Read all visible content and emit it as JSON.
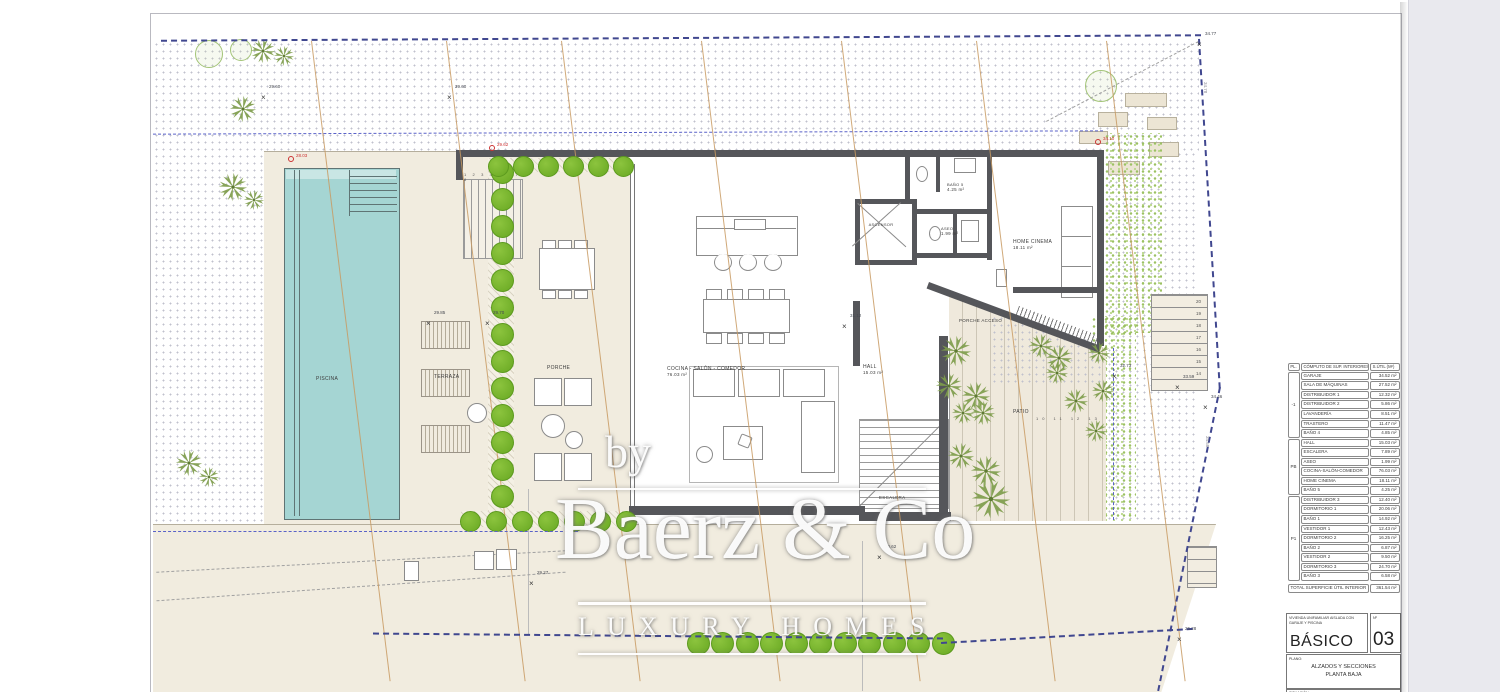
{
  "watermark": {
    "by": "by",
    "brand": "Baerz & Co",
    "tagline": "LUXURY HOMES"
  },
  "rooms": {
    "piscina": {
      "label": "PISCINA"
    },
    "terraza": {
      "label": "TERRAZA"
    },
    "porche": {
      "label": "PORCHE"
    },
    "cocina": {
      "label": "COCINA - SALÓN - COMEDOR",
      "area": "76.03 m²"
    },
    "hall": {
      "label": "HALL",
      "area": "15.03 m²"
    },
    "ascensor": {
      "label": "ASCENSOR"
    },
    "bano5": {
      "label": "BAÑO 5",
      "area": "4.25 m²"
    },
    "aseo": {
      "label": "ASEO",
      "area": "1.99 m²"
    },
    "home_cinema": {
      "label": "HOME CINEMA",
      "area": "18.11 m²"
    },
    "porche_acceso": {
      "label": "PORCHE ACCESO"
    },
    "patio": {
      "label": "PATIO"
    },
    "escalera": {
      "label": "ESCALERA"
    }
  },
  "stairs": {
    "porch_numbers": "1 2 3 4 5 6 7 8",
    "exterior_numbers": [
      "20",
      "19",
      "18",
      "17",
      "16",
      "15",
      "14"
    ],
    "patio_numbers": "10  11  12  13"
  },
  "site_markers": [
    {
      "label": "34.77",
      "x": 1196,
      "y": 33,
      "type": "x",
      "color": "#44474f"
    },
    {
      "label": "34.78",
      "x": 1207,
      "y": 84,
      "type": "plain",
      "color": "#8b8b95"
    },
    {
      "label": "29.60",
      "x": 260,
      "y": 86,
      "type": "x",
      "color": "#44474f"
    },
    {
      "label": "29.60",
      "x": 446,
      "y": 86,
      "type": "x",
      "color": "#44474f"
    },
    {
      "label": "28.03",
      "x": 287,
      "y": 155,
      "type": "dot",
      "color": "#cc3333"
    },
    {
      "label": "29.62",
      "x": 488,
      "y": 144,
      "type": "dot",
      "color": "#cc3333"
    },
    {
      "label": "34.10",
      "x": 1094,
      "y": 138,
      "type": "dot",
      "color": "#cc3333"
    },
    {
      "label": "29.85",
      "x": 425,
      "y": 312,
      "type": "x",
      "color": "#44474f"
    },
    {
      "label": "29.70",
      "x": 484,
      "y": 312,
      "type": "x",
      "color": "#44474f"
    },
    {
      "label": "31.12",
      "x": 841,
      "y": 315,
      "type": "x",
      "color": "#44474f"
    },
    {
      "label": "32.73",
      "x": 1111,
      "y": 365,
      "type": "x",
      "color": "#44474f"
    },
    {
      "label": "33.59",
      "x": 1174,
      "y": 376,
      "type": "x",
      "color": "#44474f"
    },
    {
      "label": "34.46",
      "x": 1202,
      "y": 396,
      "type": "x",
      "color": "#44474f"
    },
    {
      "label": "34.58",
      "x": 1209,
      "y": 438,
      "type": "plain",
      "color": "#8b8b95"
    },
    {
      "label": "29.27",
      "x": 528,
      "y": 572,
      "type": "x",
      "color": "#44474f"
    },
    {
      "label": "30.62",
      "x": 876,
      "y": 546,
      "type": "x",
      "color": "#44474f"
    },
    {
      "label": "26.28",
      "x": 1176,
      "y": 628,
      "type": "x",
      "color": "#44474f"
    }
  ],
  "legend_table": {
    "headers": [
      "PL.",
      "CÓMPUTO DE SUP. INTERIORES",
      "S.ÚTIL (M²)"
    ],
    "groups": [
      {
        "level": "-1",
        "rows": [
          [
            "GARAJE",
            "34.52 m²"
          ],
          [
            "SALA DE MÁQUINAS",
            "27.52 m²"
          ],
          [
            "DISTRIBUIDOR 1",
            "12.32 m²"
          ],
          [
            "DISTRIBUIDOR 2",
            "5.86 m²"
          ],
          [
            "LAVANDERÍA",
            "8.51 m²"
          ],
          [
            "TRASTERO",
            "11.47 m²"
          ],
          [
            "BAÑO 4",
            "4.85 m²"
          ]
        ]
      },
      {
        "level": "PB",
        "rows": [
          [
            "HALL",
            "15.03 m²"
          ],
          [
            "ESCALERA",
            "7.89 m²"
          ],
          [
            "ASEO",
            "1.99 m²"
          ],
          [
            "COCINA-SALÓN-COMEDOR",
            "76.03 m²"
          ],
          [
            "HOME CINEMA",
            "18.11 m²"
          ],
          [
            "BAÑO 5",
            "4.25 m²"
          ]
        ]
      },
      {
        "level": "P1",
        "rows": [
          [
            "DISTRIBUIDOR 3",
            "12.40 m²"
          ],
          [
            "DORMITORIO 1",
            "20.06 m²"
          ],
          [
            "BAÑO 1",
            "14.92 m²"
          ],
          [
            "VESTIDOR 1",
            "12.43 m²"
          ],
          [
            "DORMITORIO 2",
            "16.25 m²"
          ],
          [
            "BAÑO 2",
            "6.87 m²"
          ],
          [
            "VESTIDOR 2",
            "9.50 m²"
          ],
          [
            "DORMITORIO 3",
            "24.70 m²"
          ],
          [
            "BAÑO 3",
            "6.58 m²"
          ]
        ]
      }
    ],
    "total_label": "TOTAL SUPERFICIE ÚTIL INTERIOR",
    "total_value": "361.54 m²"
  },
  "title_block": {
    "project": "VIVIENDA UNIFAMILIAR AISLADA CON GARAJE Y PISCINA",
    "phase": "BÁSICO",
    "number_label": "Nº",
    "number": "03",
    "plano_label": "PLANO:",
    "plano_line1": "ALZADOS Y SECCIONES",
    "plano_line2": "PLANTA BAJA",
    "situacion_label": "SITUACIÓN"
  },
  "colors": {
    "pool": "#a5d5d3",
    "pool_light": "#c9e6e4",
    "wall": "#55565a",
    "ground": "#f1ecdf",
    "hedge": "#74b62c",
    "palm": "#7e9c4b",
    "contour": "#c89a62",
    "boundary": "#40478f",
    "setback": "#5a62c8",
    "red_marker": "#cc3333"
  }
}
